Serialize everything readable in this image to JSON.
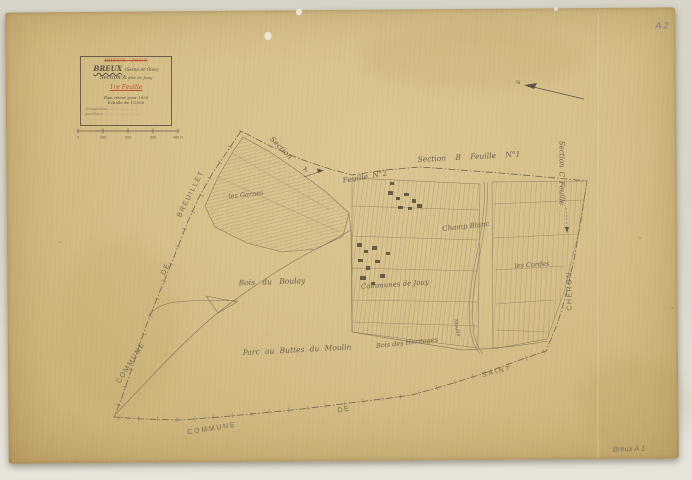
{
  "colors": {
    "paper": "#d6c08b",
    "ink": "#6a5b49",
    "red_ink": "#bf5433",
    "blue_pencil": "#67749c"
  },
  "annotations": {
    "sheet_code_top_right": "A 2",
    "sheet_code_bottom_right": "Breux A 1"
  },
  "title_block": {
    "struck_name": "BREUX - JOUY",
    "name": "BREUX",
    "departement": "(Seine-et-Oise)",
    "section": "Section A",
    "section_suffix": "dite de Jouy",
    "feuille": "1re Feuille",
    "revision": "Plan révisé pour 1955",
    "scale": "Échelle de 1/2500",
    "legend_row_1": "Triangulation ..............................",
    "legend_row_2": "parcellaire ...................................."
  },
  "scale_bar": {
    "ticks": [
      "0",
      "100",
      "200",
      "300",
      "400 m"
    ]
  },
  "compass": {
    "label": "N"
  },
  "map_labels": {
    "section_word": "Section",
    "section_letter": "A",
    "feuille_2": "Feuille N°2",
    "section_b": "Section B Feuille N°1",
    "section_c": "Section C Feuille",
    "breuillet": "BREUILLET",
    "de_west": "DE",
    "commune_west": "COMMUNE",
    "commune_south": "COMMUNE",
    "de_south": "DE",
    "saint": "SAINT",
    "cheron": "CHERON",
    "les_garnes": "les Garnes",
    "bois_du_boulay": "Bois du Boulay",
    "communes_de_jouy": "Communes de Jouy",
    "parc_buttes": "Parc au Buttes du Moulin",
    "bois_heritages": "Bois des Heritages",
    "champ_blanc": "Champ Blanc",
    "les_cordes": "les Cordes",
    "moulin": "Moulin"
  }
}
